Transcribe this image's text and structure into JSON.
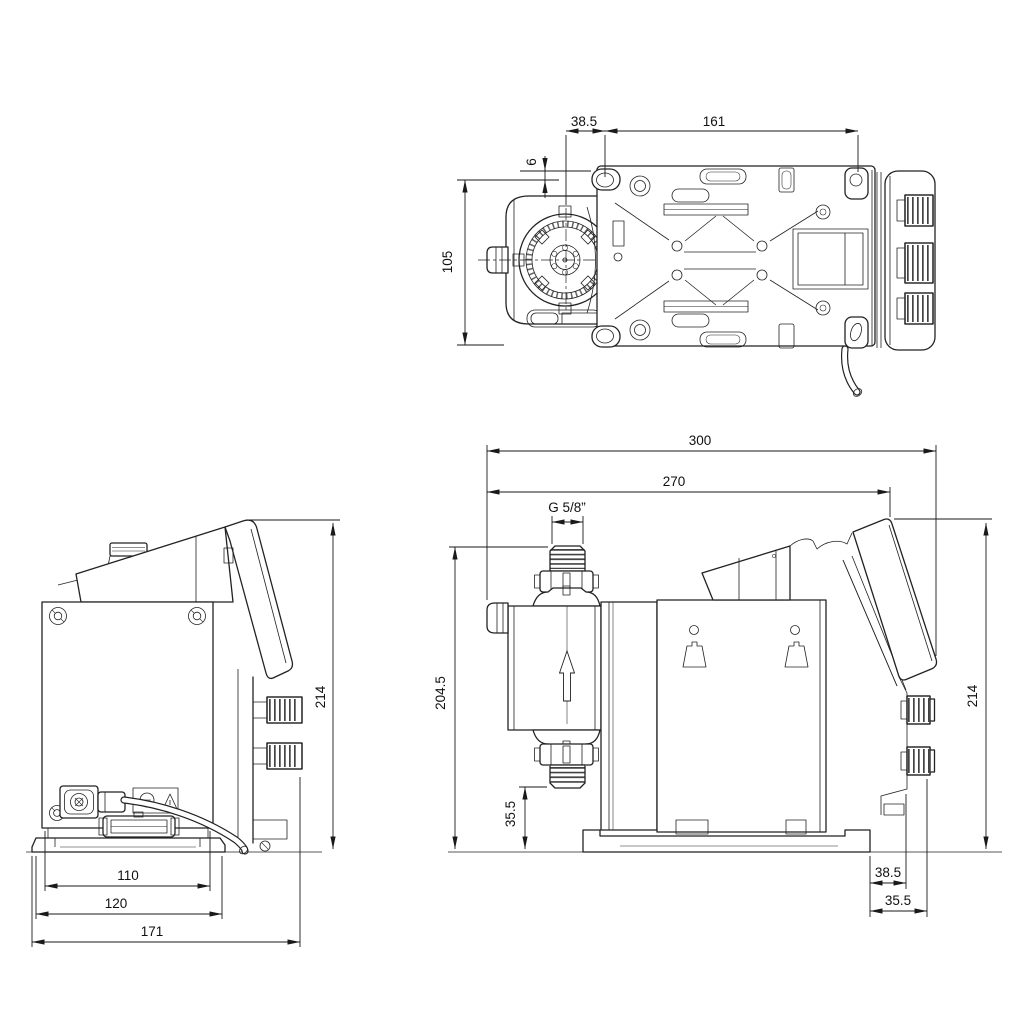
{
  "drawing": {
    "kind": "pump-dimensional-drawing",
    "background_color": "#ffffff",
    "line_color": "#222222",
    "views": {
      "top": {
        "dims": {
          "head_center_to_hole": "38.5",
          "hole_spacing": "161",
          "slot_offset": "6",
          "plate_width": "105"
        }
      },
      "rear": {
        "dims": {
          "overall_height": "214",
          "plate_width": "110",
          "base_width": "120",
          "overall_width": "171"
        }
      },
      "side": {
        "dims": {
          "overall_length": "300",
          "length_to_panel": "270",
          "connection_thread": "G 5/8”",
          "suction_valve_height": "204.5",
          "valve_clearance": "35.5",
          "panel_height": "214",
          "base_to_plug": "38.5",
          "base_to_knob": "35.5"
        }
      }
    }
  }
}
